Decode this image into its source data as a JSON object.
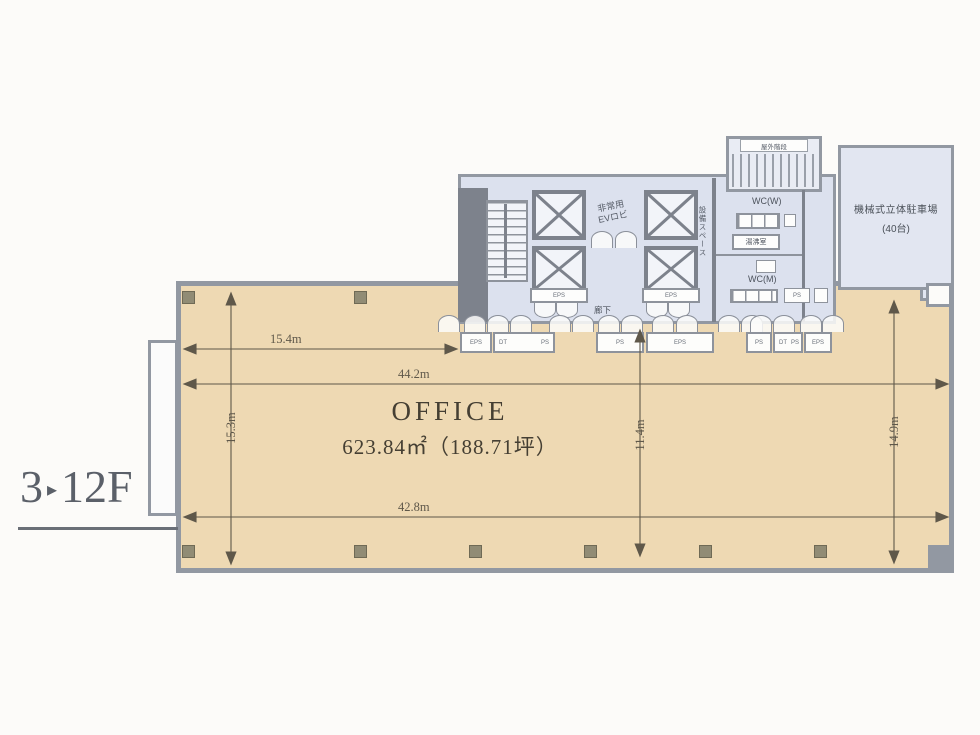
{
  "floor_label": {
    "number": "3",
    "separator": "▸",
    "range": "12F"
  },
  "office": {
    "label": "OFFICE",
    "area": "623.84㎡（188.71坪）"
  },
  "dimensions": {
    "top_partial": "15.4m",
    "full_width": "44.2m",
    "bottom_width": "42.8m",
    "left_height": "15.3m",
    "center_height": "11.4m",
    "right_height": "14.9m"
  },
  "core": {
    "ev_lobby_line1": "非常用",
    "ev_lobby_line2": "EVロビ",
    "equipment_space": "設備スペース",
    "corridor": "廊下",
    "outdoor_stairs": "屋外階段",
    "wc_women": "WC(W)",
    "wc_men": "WC(M)",
    "kitchenette": "湯沸室",
    "eps_left": "EPS",
    "eps_right": "EPS",
    "ps_wc": "PS"
  },
  "parking": {
    "name": "機械式立体駐車場",
    "capacity": "(40台)"
  },
  "entry_boxes": [
    {
      "labels": [
        "EPS"
      ]
    },
    {
      "labels": [
        "DT",
        "PS"
      ]
    },
    {
      "labels": [
        "PS"
      ]
    },
    {
      "labels": [
        "EPS"
      ]
    },
    {
      "labels": [
        "PS"
      ]
    },
    {
      "labels": [
        "DT",
        "PS"
      ]
    },
    {
      "labels": [
        "EPS"
      ]
    }
  ],
  "colors": {
    "office_fill": "#eed9b3",
    "core_fill": "#dce1ee",
    "wall": "#9298a2",
    "dark_wall": "#7d828c",
    "column": "#918c75",
    "dimension": "#5f584a"
  }
}
